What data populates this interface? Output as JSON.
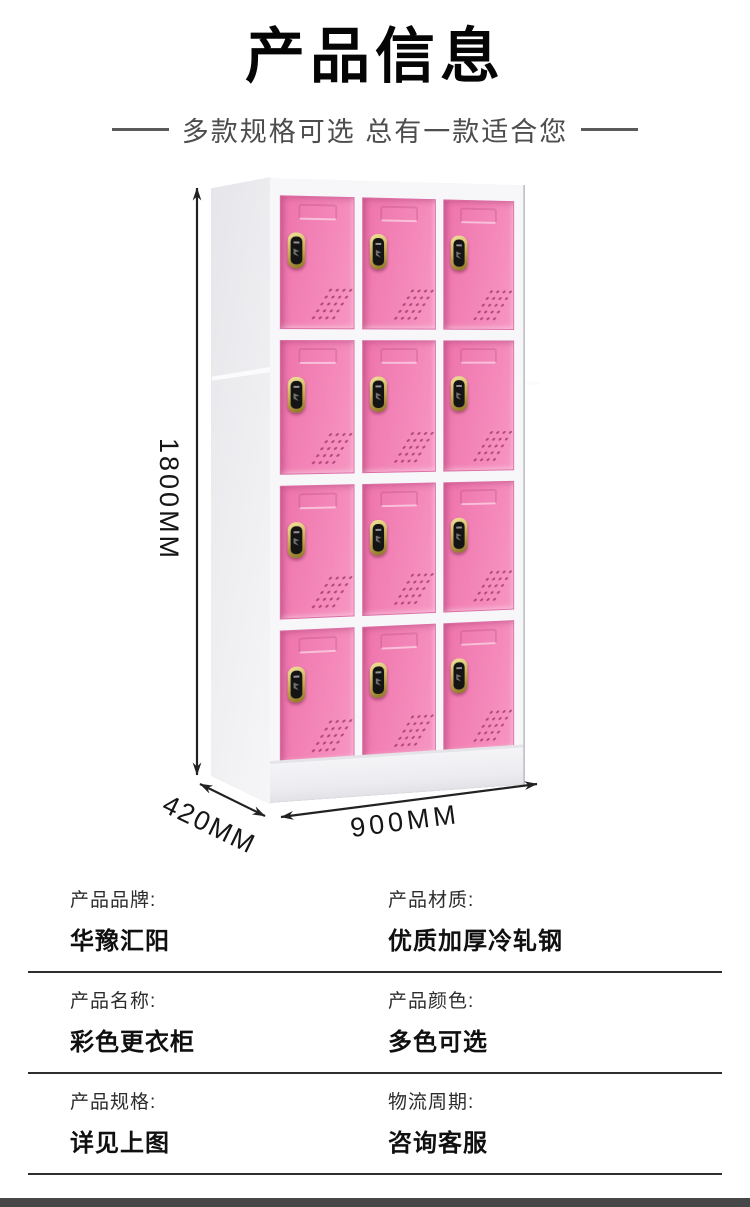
{
  "header": {
    "title": "产品信息",
    "subtitle": "多款规格可选 总有一款适合您"
  },
  "figure": {
    "dimensions": {
      "height": "1800MM",
      "depth": "420MM",
      "width": "900MM"
    },
    "locker": {
      "rows": 4,
      "columns": 3,
      "door_color": "#f386b8",
      "frame_color": "#f7f7f9",
      "lock_color": "#c3a74e",
      "arrow_color": "#222222"
    }
  },
  "specs": {
    "rows": [
      {
        "left": {
          "label": "产品品牌:",
          "value": "华豫汇阳"
        },
        "right": {
          "label": "产品材质:",
          "value": "优质加厚冷轧钢"
        }
      },
      {
        "left": {
          "label": "产品名称:",
          "value": "彩色更衣柜"
        },
        "right": {
          "label": "产品颜色:",
          "value": "多色可选"
        }
      },
      {
        "left": {
          "label": "产品规格:",
          "value": "详见上图"
        },
        "right": {
          "label": "物流周期:",
          "value": "咨询客服"
        }
      }
    ]
  },
  "footer": {
    "bar_color": "#474747"
  }
}
